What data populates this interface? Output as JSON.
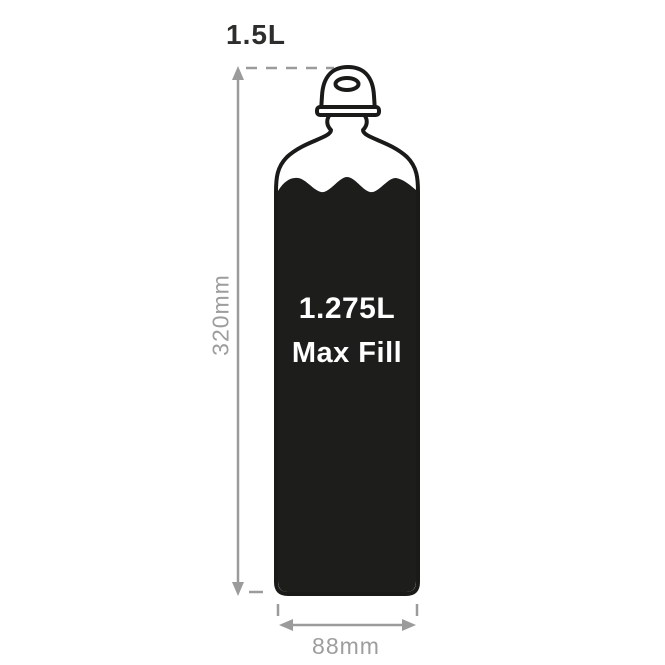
{
  "diagram": {
    "capacity_label": "1.5L",
    "height_label": "320mm",
    "width_label": "88mm",
    "bottle": {
      "max_fill_volume": "1.275L",
      "max_fill_text": "Max Fill"
    },
    "colors": {
      "background": "#ffffff",
      "outline": "#1a1a18",
      "fill": "#1d1d1b",
      "dimension": "#9b9b9b",
      "dimension_text": "#9d9d9c",
      "capacity_text": "#2d2d2c",
      "bottle_text": "#ffffff"
    }
  }
}
